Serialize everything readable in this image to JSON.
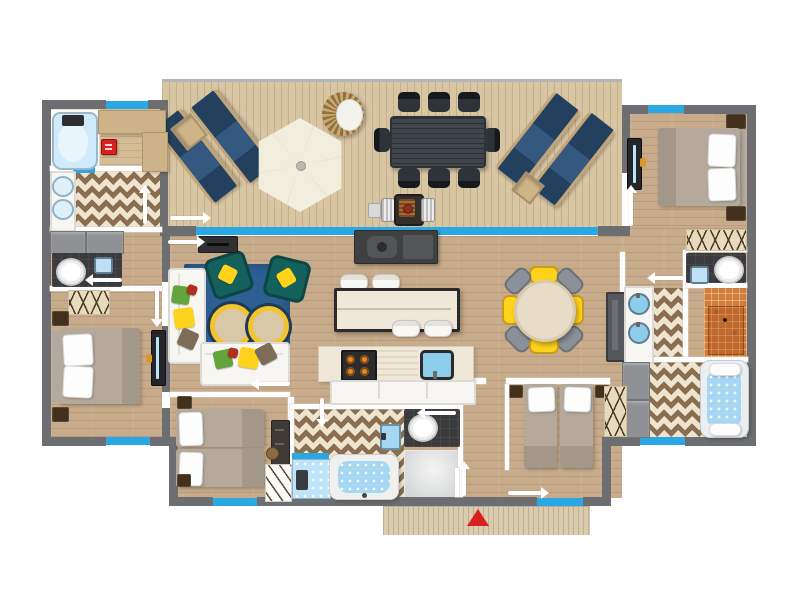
{
  "meta": {
    "kind": "apartment-floor-plan",
    "view": "top-down",
    "style": "flat vector illustration",
    "visible_text": ""
  },
  "colors": {
    "wall": "#6d6e71",
    "window": "#29a8e4",
    "floor": "#c7ab8b",
    "terraceFloor": "#d8c6a3",
    "porchFloor": "#d9cdad",
    "chevron": "#8a6e50",
    "chevronBg": "#efe4cf",
    "rug": "#2d5f92",
    "teal": "#14605c",
    "yellow": "#ffd21c",
    "green": "#64a43c",
    "red": "#d92020",
    "navy": "#2c4a74",
    "loungerFrame": "#c2a477",
    "umbrella": "#f1ecdb",
    "darkFurniture": "#3c4046",
    "counter": "#efe7d8",
    "burner": "#e08a28",
    "sinkBlue": "#8ccdec",
    "waterBlue": "#a5d7f2",
    "mosaic": "#d07c3a",
    "darkRoom": "#3b3b3d",
    "cabinetGray": "#8f9194",
    "blanket": "#b5a99c",
    "nightstand": "#42301d"
  },
  "legend": {
    "window_marker": "cyan strip on wall",
    "door_marker": "white swing arrow",
    "entrance_marker": "red triangle at porch"
  },
  "markers": {
    "window_count": 8,
    "door_arrow_count": 12,
    "entrance_arrow_count": 1
  },
  "rooms": [
    {
      "name": "terrace",
      "items": [
        "sun-lounger x2 (left pair)",
        "side-table",
        "parasol",
        "hanging-egg-chair",
        "outdoor-dining-table",
        "dining-chair x8",
        "bbq-grill",
        "sun-lounger x2 (right pair)",
        "side-table"
      ]
    },
    {
      "name": "bathroom-top-left",
      "items": [
        "bathtub",
        "bench",
        "red-kit-box",
        "washbasin x2",
        "storage-cabinet x2",
        "toilet",
        "mini-washbasin",
        "wardrobe"
      ]
    },
    {
      "name": "bedroom-top-right",
      "items": [
        "double-bed",
        "pillow x2",
        "nightstand x2",
        "wall-tv",
        "wardrobe"
      ]
    },
    {
      "name": "living-room",
      "items": [
        "sofa x2",
        "armchair x2",
        "round-coffee-table x2",
        "blue-rug",
        "cushion x8",
        "wall-console",
        "media-fireplace-unit"
      ]
    },
    {
      "name": "kitchen",
      "items": [
        "island-table",
        "stool x4",
        "counter",
        "hob-4-burners",
        "sink",
        "base-cabinets",
        "tall-cabinet"
      ]
    },
    {
      "name": "dining-area",
      "items": [
        "round-table",
        "yellow-chair x4",
        "grey-chair x4"
      ]
    },
    {
      "name": "bathroom-right",
      "items": [
        "toilet",
        "mini-washbasin",
        "mosaic-shower",
        "double-vanity",
        "storage-cabinet x2",
        "jacuzzi-bathtub"
      ]
    },
    {
      "name": "bedroom-bottom-left",
      "items": [
        "double-bed",
        "pillow x2",
        "nightstand x2",
        "wall-tv",
        "wardrobe"
      ]
    },
    {
      "name": "bedroom-twin-left",
      "items": [
        "single-bed x2",
        "nightstand x2",
        "dresser",
        "round-stool",
        "towel-ladder"
      ]
    },
    {
      "name": "bathroom-bottom-center",
      "items": [
        "shower-cabin",
        "jacuzzi-bathtub",
        "washbasin",
        "toilet",
        "walk-in-shower"
      ]
    },
    {
      "name": "bedroom-twin-right",
      "items": [
        "single-bed x2",
        "nightstand x2",
        "wardrobe",
        "door-leaf"
      ]
    },
    {
      "name": "entrance",
      "items": [
        "porch-steps",
        "red-entrance-arrow"
      ]
    }
  ]
}
